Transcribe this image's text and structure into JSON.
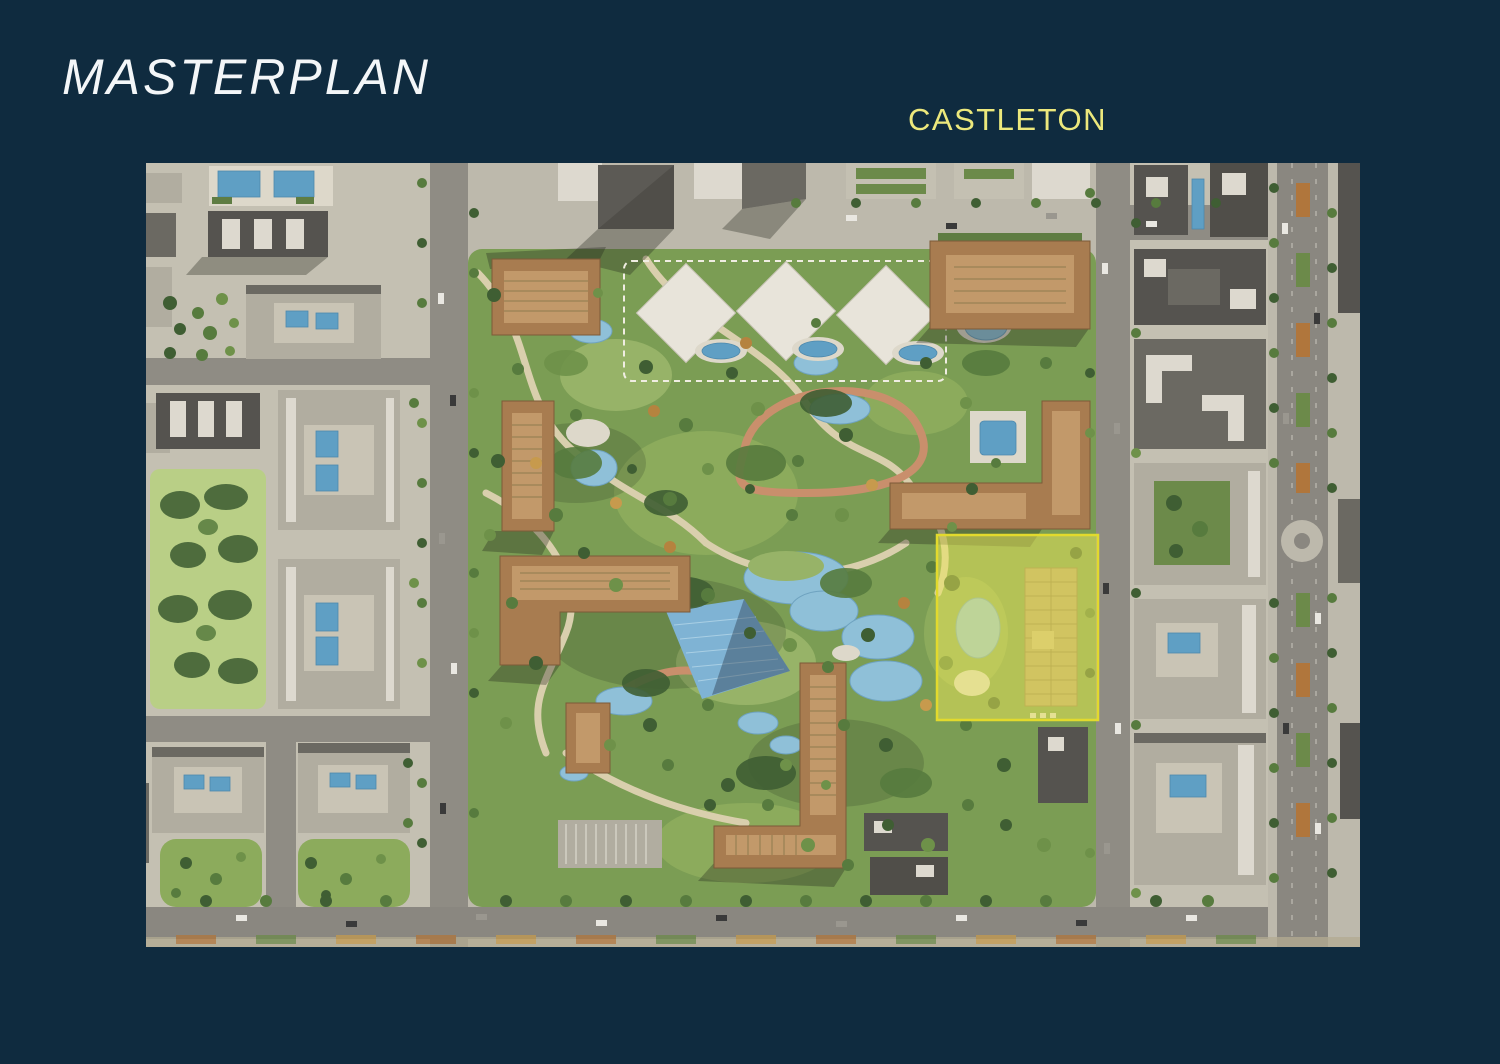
{
  "slide": {
    "title": "MASTERPLAN",
    "site_label": "CASTLETON",
    "colors": {
      "background": "#0f2b3f",
      "title_text": "#f3f6f8",
      "site_label_text": "#ece87c",
      "highlight_fill": "#ede857",
      "highlight_border": "#e2da2d"
    }
  }
}
